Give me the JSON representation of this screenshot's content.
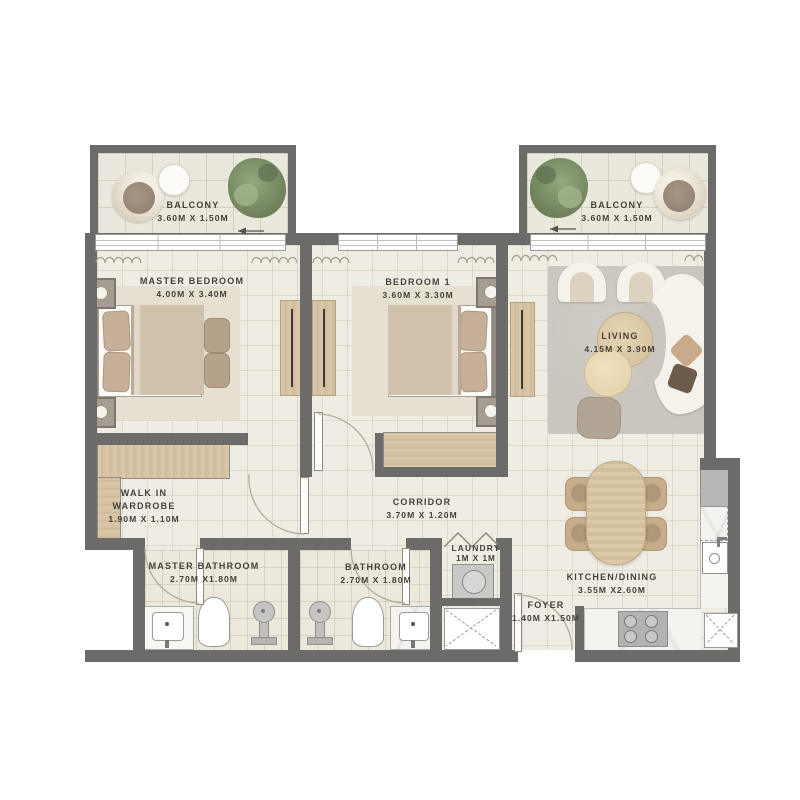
{
  "floorplan": {
    "title": "2 Bedroom Apartment Floor Plan",
    "rooms": {
      "balcony_left": {
        "name": "BALCONY",
        "dims": "3.60M X 1.50M"
      },
      "balcony_right": {
        "name": "BALCONY",
        "dims": "3.60M X 1.50M"
      },
      "master_bedroom": {
        "name": "MASTER BEDROOM",
        "dims": "4.00M X 3.40M"
      },
      "bedroom_1": {
        "name": "BEDROOM 1",
        "dims": "3.60M X 3.30M"
      },
      "living": {
        "name": "LIVING",
        "dims": "4.15M X 3.90M"
      },
      "walk_in_wardrobe": {
        "name": "WALK IN WARDROBE",
        "dims": "1.90M X 1.10M"
      },
      "corridor": {
        "name": "CORRIDOR",
        "dims": "3.70M X 1.20M"
      },
      "master_bathroom": {
        "name": "MASTER BATHROOM",
        "dims": "2.70M X1.80M"
      },
      "bathroom": {
        "name": "BATHROOM",
        "dims": "2.70M X 1.80M"
      },
      "laundry": {
        "name": "LAUNDRY",
        "dims": "1M X 1M"
      },
      "foyer": {
        "name": "FOYER",
        "dims": "1.40M X1.50M"
      },
      "kitchen_dining": {
        "name": "KITCHEN/DINING",
        "dims": "3.55M X2.60M"
      }
    },
    "colors": {
      "wall": "#6c6b69",
      "floor": "#efece4",
      "wood": "#d6c2a2",
      "rug_living": "#cac6be",
      "rug_bedroom": "#e6e0d3",
      "text": "#45413a"
    }
  }
}
